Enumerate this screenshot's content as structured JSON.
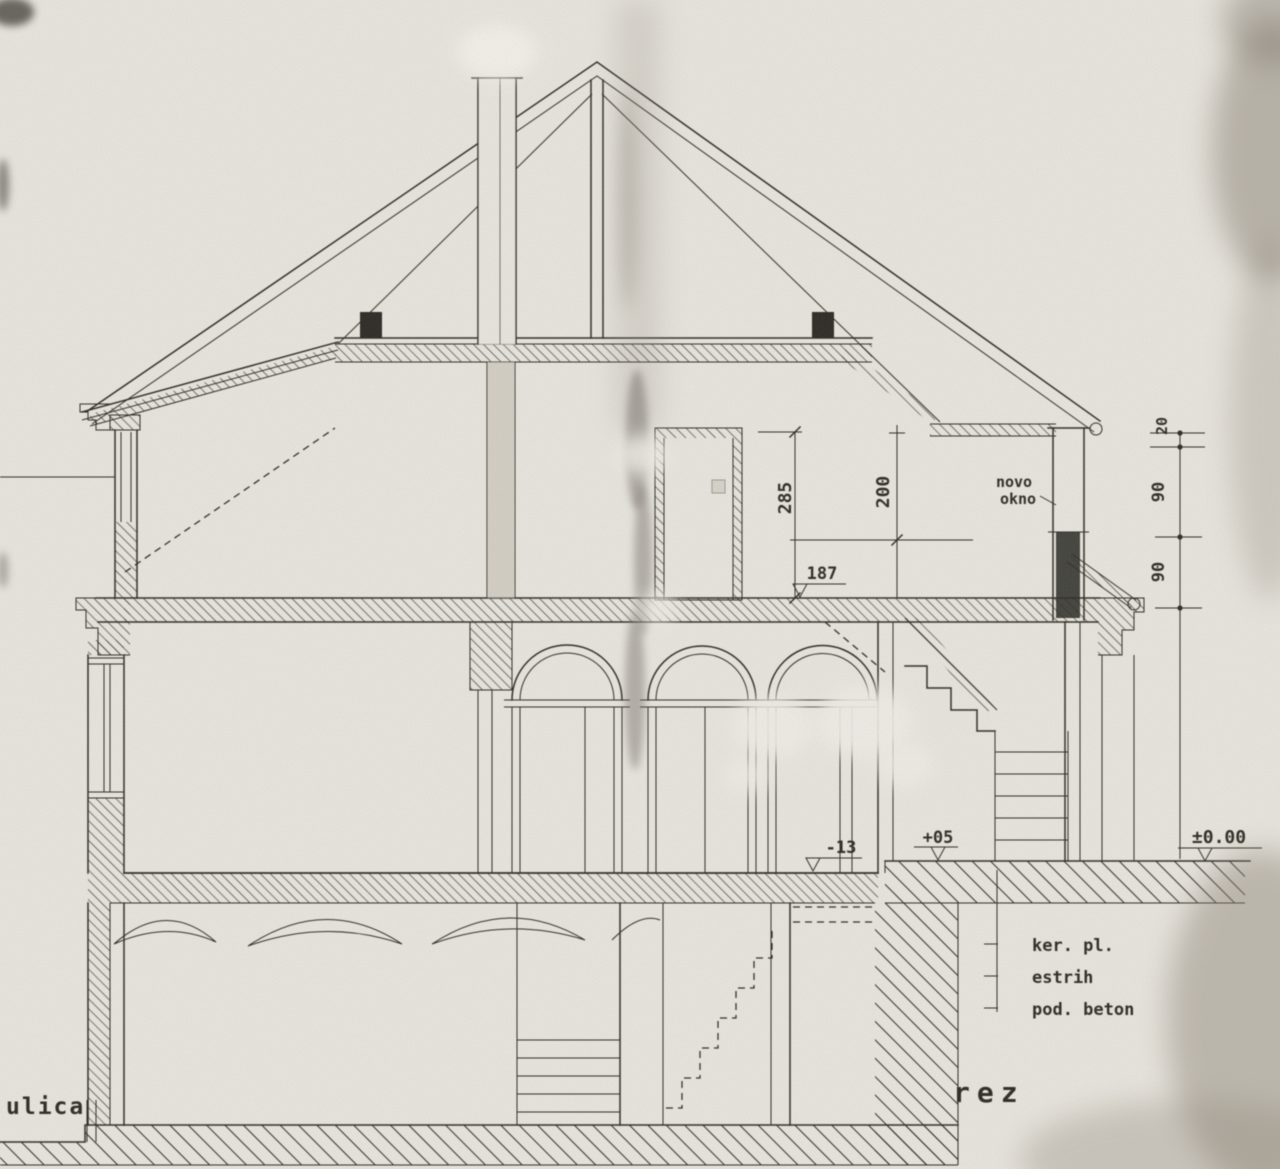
{
  "drawing": {
    "section_label": "rez",
    "street_label": "ulica",
    "window_note_line1": "novo",
    "window_note_line2": "okno",
    "levels": {
      "attic_floor": "187",
      "ground_left": "-13",
      "ground_right": "+05",
      "terrain_zero": "±0.00"
    },
    "dims": {
      "attic_clear": "285",
      "upper_room": "200",
      "chain_top": "20",
      "chain_mid": "90",
      "chain_bottom": "90"
    },
    "floor_layers": [
      "ker. pl.",
      "estrih",
      "pod. beton"
    ],
    "colors": {
      "ink": "#2b2822",
      "paper": "#e9e6df"
    }
  }
}
